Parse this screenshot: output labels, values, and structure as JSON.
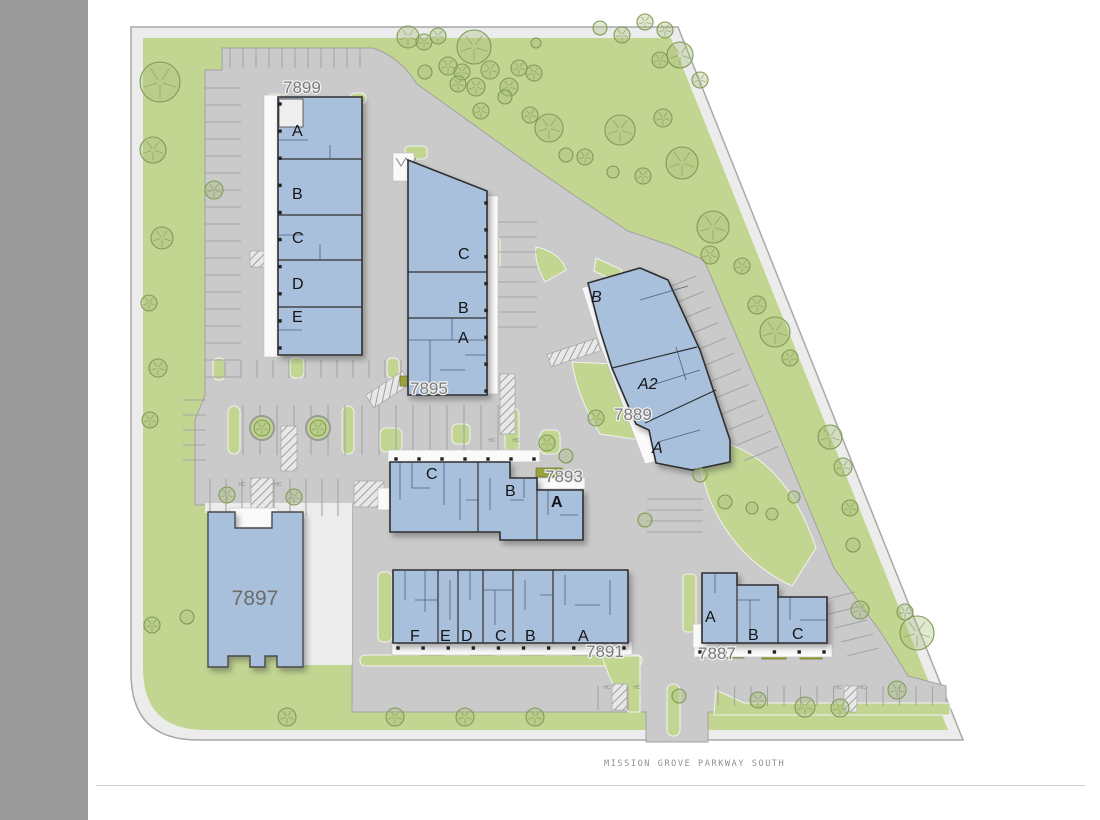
{
  "site": {
    "street_label": "MISSION GROVE PARKWAY SOUTH",
    "hc_label": "HC"
  },
  "buildings": {
    "b7899": {
      "number": "7899",
      "units": [
        "A",
        "B",
        "C",
        "D",
        "E"
      ]
    },
    "b7895": {
      "number": "7895",
      "units": [
        "C",
        "B",
        "A"
      ]
    },
    "b7889": {
      "number": "7889",
      "units": [
        "B",
        "A2",
        "A"
      ]
    },
    "b7893": {
      "number": "7893",
      "units": [
        "C",
        "B",
        "A"
      ]
    },
    "b7897": {
      "number": "7897",
      "units": []
    },
    "b7891": {
      "number": "7891",
      "units": [
        "F",
        "E",
        "D",
        "C",
        "B",
        "A"
      ]
    },
    "b7887": {
      "number": "7887",
      "units": [
        "A",
        "B",
        "C"
      ]
    }
  },
  "colors": {
    "landscape": "#c2d691",
    "paving": "#cacaca",
    "rim": "#ececec",
    "building": "#a9c0dd",
    "outline": "#2f2f2f",
    "leftbar": "#9b9b9b",
    "tree": "#7f9a55",
    "olive": "#9aa23f"
  },
  "trees": [
    [
      160,
      82,
      20
    ],
    [
      153,
      150,
      13
    ],
    [
      214,
      190,
      9
    ],
    [
      162,
      238,
      11
    ],
    [
      149,
      303,
      8
    ],
    [
      158,
      368,
      9
    ],
    [
      150,
      420,
      8
    ],
    [
      152,
      625,
      8
    ],
    [
      187,
      617,
      7
    ],
    [
      287,
      717,
      9
    ],
    [
      408,
      37,
      11
    ],
    [
      424,
      42,
      8
    ],
    [
      438,
      36,
      8
    ],
    [
      474,
      47,
      17
    ],
    [
      448,
      66,
      9
    ],
    [
      425,
      72,
      7
    ],
    [
      462,
      72,
      8
    ],
    [
      490,
      70,
      9
    ],
    [
      519,
      68,
      8
    ],
    [
      536,
      43,
      5
    ],
    [
      458,
      84,
      8
    ],
    [
      476,
      87,
      9
    ],
    [
      509,
      87,
      9
    ],
    [
      534,
      73,
      8
    ],
    [
      481,
      111,
      8
    ],
    [
      505,
      97,
      7
    ],
    [
      530,
      115,
      8
    ],
    [
      549,
      128,
      14
    ],
    [
      566,
      155,
      7
    ],
    [
      585,
      157,
      8
    ],
    [
      620,
      130,
      15
    ],
    [
      643,
      176,
      8
    ],
    [
      613,
      172,
      6
    ],
    [
      600,
      28,
      7
    ],
    [
      622,
      35,
      8
    ],
    [
      645,
      22,
      8
    ],
    [
      665,
      30,
      8
    ],
    [
      680,
      55,
      13
    ],
    [
      700,
      80,
      8
    ],
    [
      660,
      60,
      8
    ],
    [
      663,
      118,
      9
    ],
    [
      682,
      163,
      16
    ],
    [
      713,
      227,
      16
    ],
    [
      710,
      255,
      9
    ],
    [
      742,
      266,
      8
    ],
    [
      757,
      305,
      9
    ],
    [
      775,
      332,
      15
    ],
    [
      790,
      358,
      8
    ],
    [
      830,
      437,
      12
    ],
    [
      843,
      467,
      9
    ],
    [
      850,
      508,
      8
    ],
    [
      853,
      545,
      7
    ],
    [
      860,
      610,
      9
    ],
    [
      917,
      633,
      17
    ],
    [
      905,
      612,
      8
    ],
    [
      897,
      690,
      9
    ],
    [
      840,
      708,
      9
    ],
    [
      805,
      707,
      10
    ],
    [
      395,
      717,
      9
    ],
    [
      465,
      717,
      9
    ],
    [
      535,
      717,
      9
    ],
    [
      679,
      696,
      7
    ],
    [
      758,
      700,
      8
    ],
    [
      262,
      428,
      8
    ],
    [
      318,
      428,
      8
    ],
    [
      547,
      443,
      8
    ],
    [
      566,
      456,
      7
    ],
    [
      596,
      418,
      8
    ],
    [
      227,
      495,
      8
    ],
    [
      294,
      497,
      8
    ],
    [
      645,
      520,
      7
    ],
    [
      700,
      475,
      7
    ],
    [
      725,
      502,
      7
    ],
    [
      752,
      508,
      6
    ],
    [
      772,
      514,
      6
    ],
    [
      794,
      497,
      6
    ]
  ],
  "parking_rows": [
    {
      "x": 205,
      "y": 88,
      "sx": 0,
      "sy": 17,
      "n": 18,
      "tx": 36,
      "ty": 0
    },
    {
      "x": 230,
      "y": 48,
      "sx": 13,
      "sy": 0,
      "n": 11,
      "tx": 0,
      "ty": 20
    },
    {
      "x": 497,
      "y": 222,
      "sx": 0,
      "sy": 15,
      "n": 8,
      "tx": 40,
      "ty": 0
    },
    {
      "x": 243,
      "y": 405,
      "sx": 17,
      "sy": 0,
      "n": 16,
      "tx": 0,
      "ty": 50
    },
    {
      "x": 225,
      "y": 360,
      "sx": 16,
      "sy": 0,
      "n": 15,
      "tx": 0,
      "ty": 18
    },
    {
      "x": 210,
      "y": 479,
      "sx": 16,
      "sy": 0,
      "n": 9,
      "tx": 0,
      "ty": 37
    },
    {
      "x": 696,
      "y": 276,
      "sx": 7.5,
      "sy": 15.5,
      "n": 12,
      "tx": -34,
      "ty": 14
    },
    {
      "x": 647,
      "y": 499,
      "sx": 0,
      "sy": 11,
      "n": 4,
      "tx": 56,
      "ty": 0
    },
    {
      "x": 718,
      "y": 686,
      "sx": 16.5,
      "sy": 0,
      "n": 14,
      "tx": 0,
      "ty": 20
    },
    {
      "x": 598,
      "y": 686,
      "sx": 15,
      "sy": 0,
      "n": 3,
      "tx": 0,
      "ty": 24
    },
    {
      "x": 183,
      "y": 400,
      "sx": 0,
      "sy": 15,
      "n": 5,
      "tx": 23,
      "ty": 0
    },
    {
      "x": 855,
      "y": 592,
      "sx": 6,
      "sy": 14,
      "n": 5,
      "tx": -32,
      "ty": 8
    }
  ],
  "column_dots": [
    {
      "x1": 280,
      "y1": 104,
      "x2": 280,
      "y2": 348,
      "n": 10
    },
    {
      "x1": 486,
      "y1": 203,
      "x2": 486,
      "y2": 391,
      "n": 8
    },
    {
      "x1": 396,
      "y1": 459,
      "x2": 534,
      "y2": 459,
      "n": 7
    },
    {
      "x1": 398,
      "y1": 648,
      "x2": 624,
      "y2": 648,
      "n": 10
    },
    {
      "x1": 700,
      "y1": 652,
      "x2": 824,
      "y2": 652,
      "n": 6
    }
  ],
  "hc_marks": [
    [
      242,
      486
    ],
    [
      278,
      486
    ],
    [
      492,
      442
    ],
    [
      516,
      442
    ],
    [
      607,
      689
    ],
    [
      637,
      689
    ],
    [
      838,
      689
    ],
    [
      862,
      689
    ]
  ]
}
